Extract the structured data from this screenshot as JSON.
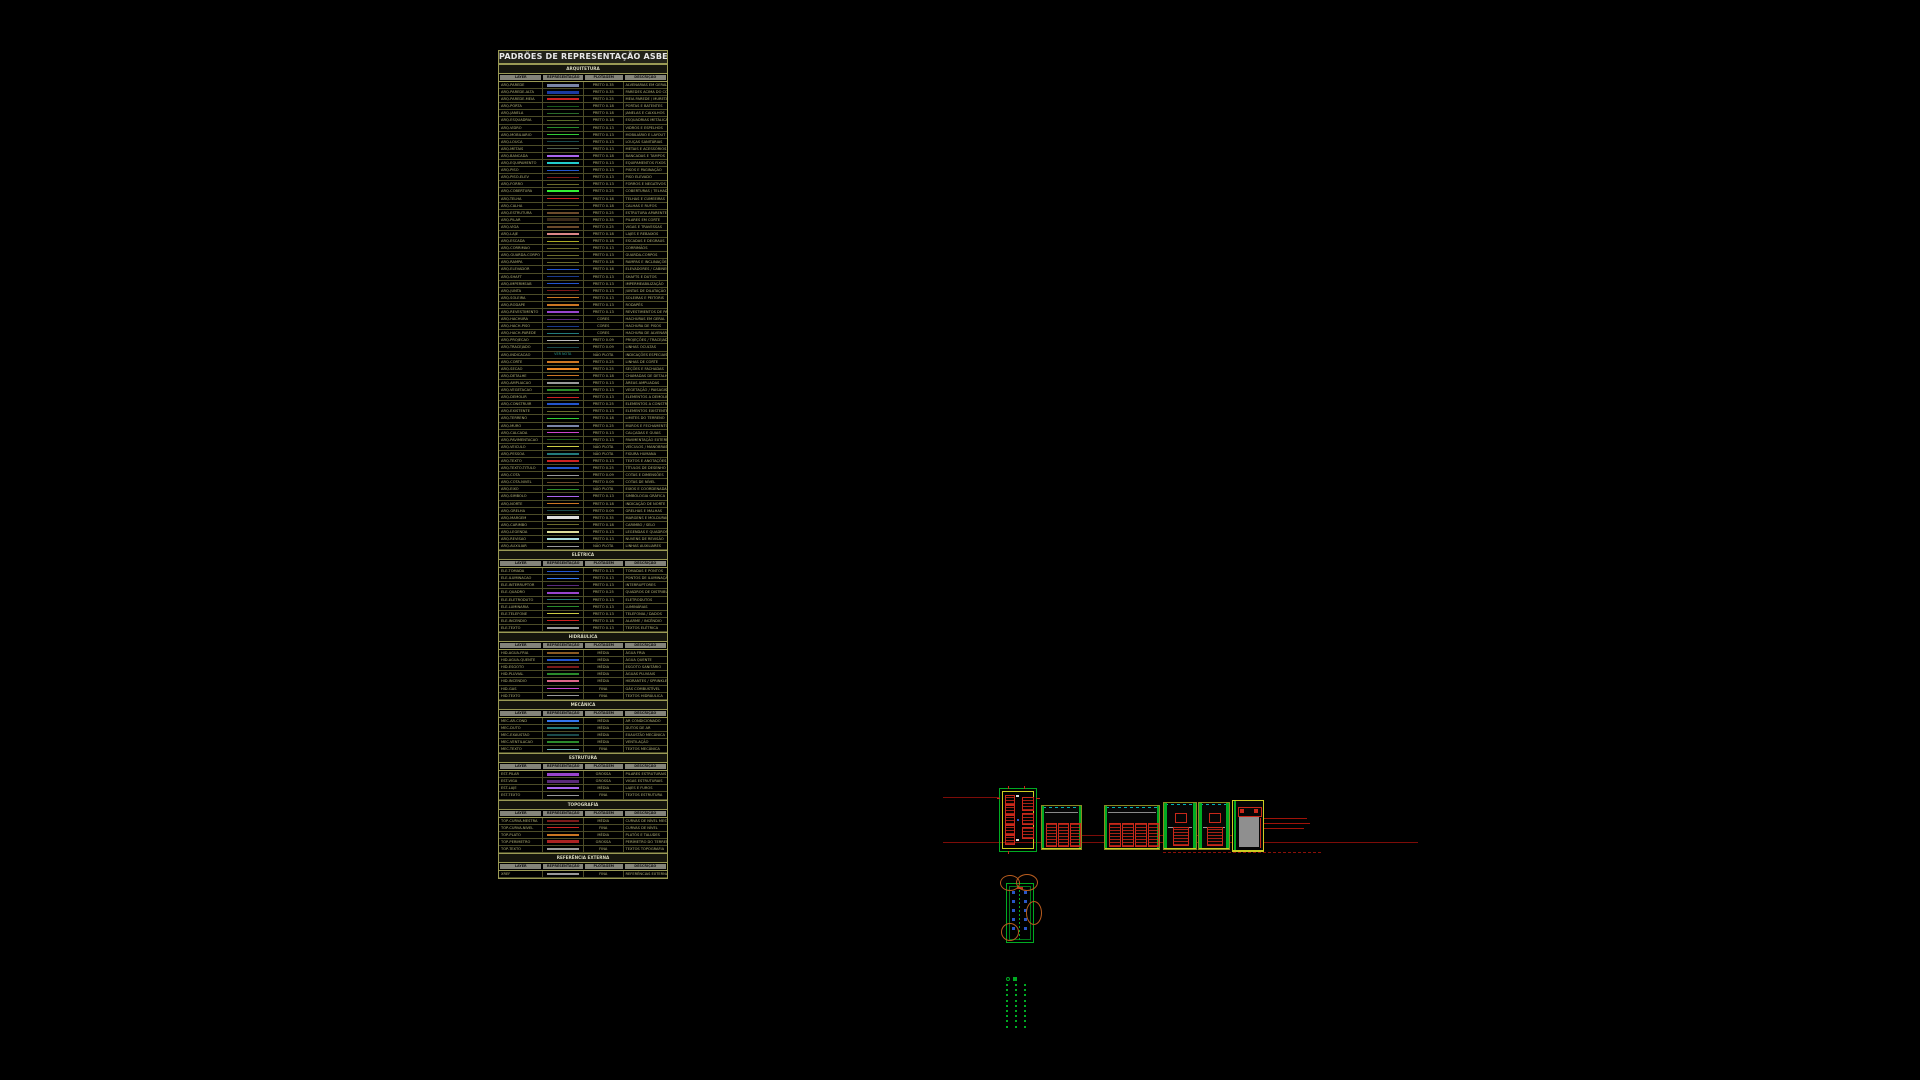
{
  "palette": {
    "table_border": "#9a9a55",
    "cad_green": "#00aa22",
    "cad_yellow": "#cccc22",
    "cad_red": "#c8281a",
    "cad_dimred": "#7d0c08",
    "cad_cyan": "#00b2b2",
    "cad_blue": "#2a55c8",
    "cad_orange": "#b85c1e"
  },
  "annotations": {
    "red_label": "ABS — JANELAS — LAYOUT"
  },
  "table": {
    "title": "PADRÕES DE REPRESENTAÇÃO ASBEA",
    "columns": [
      "LAYER",
      "REPRESENTAÇÃO",
      "PLOTAGEM",
      "DESCRIÇÃO"
    ],
    "sections": [
      {
        "name": "ARQUITETURA",
        "rows": [
          {
            "layer": "ARQ-PAREDE",
            "color": "#7a86a8",
            "plot": "PRETO 0.35",
            "desc": "ALVENARIAS EM GERAL"
          },
          {
            "layer": "ARQ-PAREDE-ALTA",
            "color": "#1a3aa0",
            "plot": "PRETO 0.35",
            "desc": "PAREDES ACIMA DO CORTE"
          },
          {
            "layer": "ARQ-PAREDE-MEIA",
            "color": "#cc2222",
            "plot": "PRETO 0.25",
            "desc": "MEIA PAREDE / MURETA"
          },
          {
            "layer": "ARQ-PORTA",
            "color": "#1a5a1a",
            "plot": "PRETO 0.18",
            "desc": "PORTAS E BATENTES"
          },
          {
            "layer": "ARQ-JANELA",
            "color": "#2a6a2a",
            "plot": "PRETO 0.18",
            "desc": "JANELAS E CAIXILHOS"
          },
          {
            "layer": "ARQ-ESQUADRIA",
            "color": "#5a6b2a",
            "plot": "PRETO 0.18",
            "desc": "ESQUADRIAS METÁLICAS"
          },
          {
            "layer": "ARQ-VIDRO",
            "color": "#2a8a2a",
            "plot": "PRETO 0.13",
            "desc": "VIDROS E ESPELHOS"
          },
          {
            "layer": "ARQ-MOBILIARIO",
            "color": "#33cc33",
            "plot": "PRETO 0.13",
            "desc": "MOBILIÁRIO E LAYOUT"
          },
          {
            "layer": "ARQ-LOUCA",
            "color": "#1a4a4a",
            "plot": "PRETO 0.13",
            "desc": "LOUÇAS SANITÁRIAS"
          },
          {
            "layer": "ARQ-METAIS",
            "color": "#4a5a4a",
            "plot": "PRETO 0.13",
            "desc": "METAIS E ACESSÓRIOS"
          },
          {
            "layer": "ARQ-BANCADA",
            "color": "#aa66ee",
            "plot": "PRETO 0.18",
            "desc": "BANCADAS E TAMPOS"
          },
          {
            "layer": "ARQ-EQUIPAMENTO",
            "color": "#22cccc",
            "plot": "PRETO 0.13",
            "desc": "EQUIPAMENTOS FIXOS"
          },
          {
            "layer": "ARQ-PISO",
            "color": "#2255cc",
            "plot": "PRETO 0.13",
            "desc": "PISOS E PAGINAÇÃO"
          },
          {
            "layer": "ARQ-PISO-ELEV",
            "color": "#7a1a1a",
            "plot": "PRETO 0.13",
            "desc": "PISO ELEVADO"
          },
          {
            "layer": "ARQ-FORRO",
            "color": "#6b6b2a",
            "plot": "PRETO 0.13",
            "desc": "FORROS E NEGATIVOS"
          },
          {
            "layer": "ARQ-COBERTURA",
            "color": "#33ee33",
            "plot": "PRETO 0.25",
            "desc": "COBERTURAS / TELHADOS"
          },
          {
            "layer": "ARQ-TELHA",
            "color": "#cc2222",
            "plot": "PRETO 0.18",
            "desc": "TELHAS E CUMEEIRAS"
          },
          {
            "layer": "ARQ-CALHA",
            "color": "#4a4a1a",
            "plot": "PRETO 0.18",
            "desc": "CALHAS E RUFOS"
          },
          {
            "layer": "ARQ-ESTRUTURA",
            "color": "#6b4a2a",
            "plot": "PRETO 0.25",
            "desc": "ESTRUTURA APARENTE"
          },
          {
            "layer": "ARQ-PILAR",
            "color": "#3a2a1a",
            "plot": "PRETO 0.35",
            "desc": "PILARES EM CORTE"
          },
          {
            "layer": "ARQ-VIGA",
            "color": "#6b4a2a",
            "plot": "PRETO 0.25",
            "desc": "VIGAS E TRAVESSAS"
          },
          {
            "layer": "ARQ-LAJE",
            "color": "#dd8888",
            "plot": "PRETO 0.18",
            "desc": "LAJES E REBAIXOS"
          },
          {
            "layer": "ARQ-ESCADA",
            "color": "#aaaa22",
            "plot": "PRETO 0.18",
            "desc": "ESCADAS E DEGRAUS"
          },
          {
            "layer": "ARQ-CORRIMAO",
            "color": "#6b6b2a",
            "plot": "PRETO 0.13",
            "desc": "CORRIMÃOS"
          },
          {
            "layer": "ARQ-GUARDA-CORPO",
            "color": "#6b6b2a",
            "plot": "PRETO 0.13",
            "desc": "GUARDA-CORPOS"
          },
          {
            "layer": "ARQ-RAMPA",
            "color": "#6b6b2a",
            "plot": "PRETO 0.18",
            "desc": "RAMPAS E INCLINAÇÕES"
          },
          {
            "layer": "ARQ-ELEVADOR",
            "color": "#2255cc",
            "plot": "PRETO 0.18",
            "desc": "ELEVADORES / CABINES"
          },
          {
            "layer": "ARQ-SHAFT",
            "color": "#1a3a8a",
            "plot": "PRETO 0.13",
            "desc": "SHAFTS E DUTOS"
          },
          {
            "layer": "ARQ-IMPERMEAB",
            "color": "#2255cc",
            "plot": "PRETO 0.13",
            "desc": "IMPERMEABILIZAÇÃO"
          },
          {
            "layer": "ARQ-JUNTA",
            "color": "#7a1a1a",
            "plot": "PRETO 0.13",
            "desc": "JUNTAS DE DILATAÇÃO"
          },
          {
            "layer": "ARQ-SOLEIRA",
            "color": "#cc7722",
            "plot": "PRETO 0.13",
            "desc": "SOLEIRAS E PEITORIS"
          },
          {
            "layer": "ARQ-RODAPE",
            "color": "#cc7722",
            "plot": "PRETO 0.13",
            "desc": "RODAPÉS"
          },
          {
            "layer": "ARQ-REVESTIMENTO",
            "color": "#9944cc",
            "plot": "PRETO 0.13",
            "desc": "REVESTIMENTOS DE PAREDE"
          },
          {
            "layer": "ARQ-HACHURA",
            "color": "#5a2a7a",
            "plot": "CORES",
            "desc": "HACHURAS EM GERAL"
          },
          {
            "layer": "ARQ-HACH-PISO",
            "color": "#1a3a8a",
            "plot": "CORES",
            "desc": "HACHURA DE PISOS"
          },
          {
            "layer": "ARQ-HACH-PAREDE",
            "color": "#227a7a",
            "plot": "CORES",
            "desc": "HACHURA DE ALVENARIA"
          },
          {
            "layer": "ARQ-PROJECAO",
            "color": "#bbbbbb",
            "plot": "PRETO 0.09",
            "desc": "PROJEÇÕES / TRACEJADOS"
          },
          {
            "layer": "ARQ-TRACEJADO",
            "color": "#1a4a4a",
            "plot": "PRETO 0.09",
            "desc": "LINHAS OCULTAS"
          },
          {
            "layer": "ARQ-INDICACAO",
            "sample_text": "VER NOTA",
            "plot": "NÃO PLOTA",
            "desc": "INDICAÇÕES ESPECIAIS"
          },
          {
            "layer": "ARQ-CORTE",
            "color": "#cc7722",
            "plot": "PRETO 0.25",
            "desc": "LINHAS DE CORTE"
          },
          {
            "layer": "ARQ-SECAO",
            "color": "#ee8822",
            "plot": "PRETO 0.25",
            "desc": "SEÇÕES E FACHADAS"
          },
          {
            "layer": "ARQ-DETALHE",
            "color": "#cc7722",
            "plot": "PRETO 0.18",
            "desc": "CHAMADAS DE DETALHE"
          },
          {
            "layer": "ARQ-AMPLIACAO",
            "color": "#999999",
            "plot": "PRETO 0.13",
            "desc": "ÁREAS AMPLIADAS"
          },
          {
            "layer": "ARQ-VEGETACAO",
            "color": "#2a8a2a",
            "plot": "PRETO 0.13",
            "desc": "VEGETAÇÃO / PAISAGISMO"
          },
          {
            "layer": "ARQ-DEMOLIR",
            "color": "#cc2222",
            "plot": "PRETO 0.13",
            "desc": "ELEMENTOS A DEMOLIR"
          },
          {
            "layer": "ARQ-CONSTRUIR",
            "color": "#2255cc",
            "plot": "PRETO 0.25",
            "desc": "ELEMENTOS A CONSTRUIR"
          },
          {
            "layer": "ARQ-EXISTENTE",
            "color": "#6b6b2a",
            "plot": "PRETO 0.13",
            "desc": "ELEMENTOS EXISTENTES"
          },
          {
            "layer": "ARQ-TERRENO",
            "color": "#33cc33",
            "plot": "PRETO 0.18",
            "desc": "LIMITES DO TERRENO"
          },
          {
            "layer": "ARQ-MURO",
            "color": "#7a86a8",
            "plot": "PRETO 0.25",
            "desc": "MUROS E FECHAMENTOS"
          },
          {
            "layer": "ARQ-CALCADA",
            "color": "#cc44cc",
            "plot": "PRETO 0.13",
            "desc": "CALÇADAS E GUIAS"
          },
          {
            "layer": "ARQ-PAVIMENTACAO",
            "color": "#1a5a1a",
            "plot": "PRETO 0.13",
            "desc": "PAVIMENTAÇÃO EXTERNA"
          },
          {
            "layer": "ARQ-VEICULO",
            "color": "#cccc44",
            "plot": "NÃO PLOTA",
            "desc": "VEÍCULOS / MANOBRAS"
          },
          {
            "layer": "ARQ-PESSOA",
            "color": "#227a7a",
            "plot": "NÃO PLOTA",
            "desc": "FIGURA HUMANA"
          },
          {
            "layer": "ARQ-TEXTO",
            "color": "#cc2222",
            "plot": "PRETO 0.13",
            "desc": "TEXTOS E ANOTAÇÕES"
          },
          {
            "layer": "ARQ-TEXTO-TITULO",
            "color": "#2255cc",
            "plot": "PRETO 0.25",
            "desc": "TÍTULOS DE DESENHO"
          },
          {
            "layer": "ARQ-COTA",
            "color": "#999999",
            "plot": "PRETO 0.09",
            "desc": "COTAS E DIMENSÕES"
          },
          {
            "layer": "ARQ-COTA-NIVEL",
            "color": "#6b4a2a",
            "plot": "PRETO 0.09",
            "desc": "COTAS DE NÍVEL"
          },
          {
            "layer": "ARQ-EIXO",
            "color": "#2a8a2a",
            "plot": "NÃO PLOTA",
            "desc": "EIXOS E COORDENADAS"
          },
          {
            "layer": "ARQ-SIMBOLO",
            "color": "#aa66ee",
            "plot": "PRETO 0.13",
            "desc": "SIMBOLOGIA GRÁFICA"
          },
          {
            "layer": "ARQ-NORTE",
            "color": "#cc7722",
            "plot": "PRETO 0.18",
            "desc": "INDICAÇÃO DE NORTE"
          },
          {
            "layer": "ARQ-GRELHA",
            "color": "#1a4a4a",
            "plot": "PRETO 0.09",
            "desc": "GRELHAS E MALHAS"
          },
          {
            "layer": "ARQ-MARGEM",
            "color": "#dddddd",
            "plot": "PRETO 0.35",
            "desc": "MARGENS E MOLDURAS"
          },
          {
            "layer": "ARQ-CARIMBO",
            "color": "#6b6b2a",
            "plot": "PRETO 0.18",
            "desc": "CARIMBO / SELO"
          },
          {
            "layer": "ARQ-LEGENDA",
            "color": "#dddd99",
            "plot": "PRETO 0.13",
            "desc": "LEGENDAS E QUADROS"
          },
          {
            "layer": "ARQ-REVISAO",
            "color": "#aadddd",
            "plot": "PRETO 0.13",
            "desc": "NUVENS DE REVISÃO"
          },
          {
            "layer": "ARQ-AUXILIAR",
            "color": "#999999",
            "plot": "NÃO PLOTA",
            "desc": "LINHAS AUXILIARES"
          }
        ]
      },
      {
        "name": "ELÉTRICA",
        "rows": [
          {
            "layer": "ELE-TOMADA",
            "color": "#2255cc",
            "plot": "PRETO 0.13",
            "desc": "TOMADAS E PONTOS"
          },
          {
            "layer": "ELE-ILUMINACAO",
            "color": "#3377ee",
            "plot": "PRETO 0.13",
            "desc": "PONTOS DE ILUMINAÇÃO"
          },
          {
            "layer": "ELE-INTERRUPTOR",
            "color": "#5a2a7a",
            "plot": "PRETO 0.13",
            "desc": "INTERRUPTORES"
          },
          {
            "layer": "ELE-QUADRO",
            "color": "#9944cc",
            "plot": "PRETO 0.25",
            "desc": "QUADROS DE DISTRIBUIÇÃO"
          },
          {
            "layer": "ELE-ELETRODUTO",
            "color": "#227a7a",
            "plot": "PRETO 0.13",
            "desc": "ELETRODUTOS"
          },
          {
            "layer": "ELE-LUMINARIA",
            "color": "#2a8a2a",
            "plot": "PRETO 0.13",
            "desc": "LUMINÁRIAS"
          },
          {
            "layer": "ELE-TELEFONE",
            "color": "#cccc44",
            "plot": "PRETO 0.13",
            "desc": "TELEFONIA / DADOS"
          },
          {
            "layer": "ELE-INCENDIO",
            "color": "#cc2222",
            "plot": "PRETO 0.18",
            "desc": "ALARME / INCÊNDIO"
          },
          {
            "layer": "ELE-TEXTO",
            "color": "#999999",
            "plot": "PRETO 0.13",
            "desc": "TEXTOS ELÉTRICA"
          }
        ]
      },
      {
        "name": "HIDRÁULICA",
        "rows": [
          {
            "layer": "HID-AGUA-FRIA",
            "color": "#8a5a22",
            "plot": "MÉDIA",
            "desc": "ÁGUA FRIA"
          },
          {
            "layer": "HID-AGUA-QUENTE",
            "color": "#2255cc",
            "plot": "MÉDIA",
            "desc": "ÁGUA QUENTE"
          },
          {
            "layer": "HID-ESGOTO",
            "color": "#7a1a1a",
            "plot": "MÉDIA",
            "desc": "ESGOTO SANITÁRIO"
          },
          {
            "layer": "HID-PLUVIAL",
            "color": "#2a8a2a",
            "plot": "MÉDIA",
            "desc": "ÁGUAS PLUVIAIS"
          },
          {
            "layer": "HID-INCENDIO",
            "color": "#dd6688",
            "plot": "MÉDIA",
            "desc": "HIDRANTES / SPRINKLERS"
          },
          {
            "layer": "HID-GAS",
            "color": "#cc44cc",
            "plot": "FINA",
            "desc": "GÁS COMBUSTÍVEL"
          },
          {
            "layer": "HID-TEXTO",
            "color": "#999999",
            "plot": "FINA",
            "desc": "TEXTOS HIDRÁULICA"
          }
        ]
      },
      {
        "name": "MECÂNICA",
        "rows": [
          {
            "layer": "MEC-AR-COND",
            "color": "#3377ee",
            "plot": "MÉDIA",
            "desc": "AR CONDICIONADO"
          },
          {
            "layer": "MEC-DUTO",
            "color": "#227a7a",
            "plot": "MÉDIA",
            "desc": "DUTOS DE AR"
          },
          {
            "layer": "MEC-EXAUSTAO",
            "color": "#1a4a4a",
            "plot": "MÉDIA",
            "desc": "EXAUSTÃO MECÂNICA"
          },
          {
            "layer": "MEC-VENTILACAO",
            "color": "#2a8a2a",
            "plot": "MÉDIA",
            "desc": "VENTILAÇÃO"
          },
          {
            "layer": "MEC-TEXTO",
            "color": "#66aaaa",
            "plot": "FINA",
            "desc": "TEXTOS MECÂNICA"
          }
        ]
      },
      {
        "name": "ESTRUTURA",
        "rows": [
          {
            "layer": "EST-PILAR",
            "color": "#9944cc",
            "plot": "GROSSA",
            "desc": "PILARES ESTRUTURAIS"
          },
          {
            "layer": "EST-VIGA",
            "color": "#5a2a7a",
            "plot": "GROSSA",
            "desc": "VIGAS ESTRUTURAIS"
          },
          {
            "layer": "EST-LAJE",
            "color": "#aa66ee",
            "plot": "MÉDIA",
            "desc": "LAJES E FUROS"
          },
          {
            "layer": "EST-TEXTO",
            "color": "#999999",
            "plot": "FINA",
            "desc": "TEXTOS ESTRUTURA"
          }
        ]
      },
      {
        "name": "TOPOGRAFIA",
        "rows": [
          {
            "layer": "TOP-CURVA-MESTRA",
            "color": "#7a1a1a",
            "plot": "MÉDIA",
            "desc": "CURVAS DE NÍVEL MESTRAS"
          },
          {
            "layer": "TOP-CURVA-NIVEL",
            "color": "#cc2222",
            "plot": "FINA",
            "desc": "CURVAS DE NÍVEL"
          },
          {
            "layer": "TOP-PLATO",
            "color": "#cc7722",
            "plot": "MÉDIA",
            "desc": "PLATÔS E TALUDES"
          },
          {
            "layer": "TOP-PERIMETRO",
            "color": "#aa2222",
            "plot": "GROSSA",
            "desc": "PERÍMETRO DO TERRENO"
          },
          {
            "layer": "TOP-TEXTO",
            "color": "#999999",
            "plot": "FINA",
            "desc": "TEXTOS TOPOGRAFIA"
          }
        ]
      },
      {
        "name": "REFERÊNCIA EXTERNA",
        "rows": [
          {
            "layer": "XREF",
            "color": "#999999",
            "plot": "FINA",
            "desc": "REFERÊNCIAS EXTERNAS"
          }
        ]
      }
    ]
  }
}
